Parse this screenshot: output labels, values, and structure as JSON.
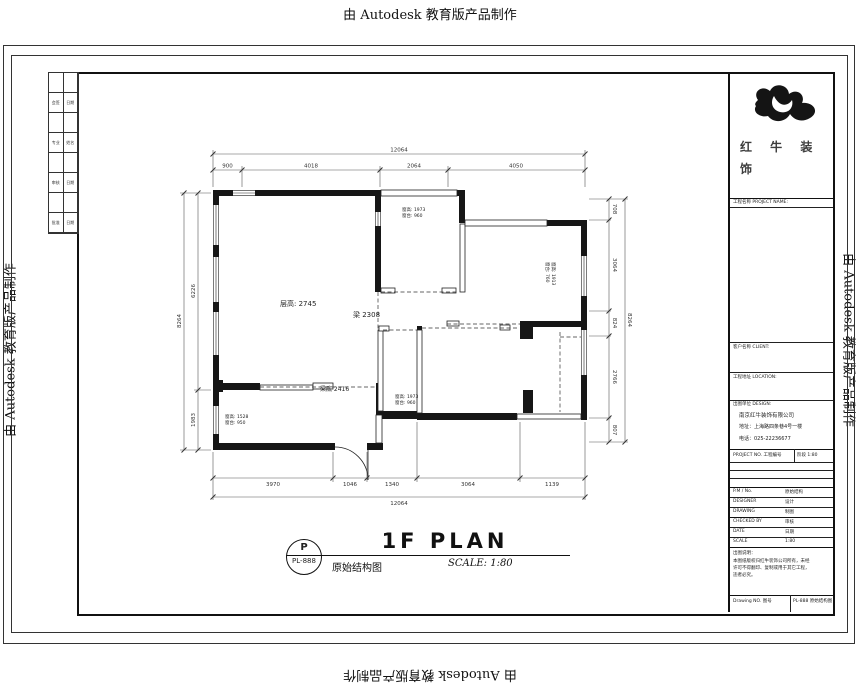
{
  "banners": {
    "top": "由 Autodesk 教育版产品制作",
    "bottom": "由 Autodesk 教育版产品制作",
    "left": "由 Autodesk 教育版产品制作",
    "right": "由 Autodesk 教育版产品制作"
  },
  "fold": {
    "rows": [
      {
        "c1": "会签",
        "c2": "日期"
      },
      {
        "c1": "专业",
        "c2": "姓名"
      },
      {
        "c1": "审核",
        "c2": "日期"
      },
      {
        "c1": "批准",
        "c2": "日期"
      }
    ]
  },
  "title_block": {
    "brand_line1": "红 牛 装",
    "brand_line2": "饰",
    "project_label": "工程名称 PROJECT NAME:",
    "client_label": "客户名称 CLIENT:",
    "location_label": "工程地址 LOCATION:",
    "design_label": "出图单位 DESIGN:",
    "company_name": "南京红牛装饰有限公司",
    "company_address": "地址：上海路四条巷4号一楼",
    "company_phone": "电话：025-22236677",
    "row_project": {
      "label": "PROJECT NO. 工程编号",
      "value": "阶段 1:80"
    },
    "rows": [
      {
        "label": "P.M / No.",
        "value": "原始结构"
      },
      {
        "label": "DESIGNER",
        "value": "设计"
      },
      {
        "label": "DRAWING",
        "value": "制图"
      },
      {
        "label": "CHECKED BY",
        "value": "审核"
      },
      {
        "label": "DATE",
        "value": "日期"
      },
      {
        "label": "SCALE",
        "value": "1:80"
      }
    ],
    "notes_title": "出图说明：",
    "notes": [
      "本图纸版权归红牛装饰公司所有，未经",
      "许可不得翻印、复制或用于其它工程，",
      "违者必究。"
    ],
    "drawing_no_label": "Drawing NO. 图号",
    "drawing_no_value": "PL-888 原始结构图"
  },
  "drawing_title": {
    "circle_top": "P",
    "circle_bottom": "PL-888",
    "title": "1F PLAN",
    "subtitle": "原始结构图",
    "scale": "SCALE: 1:80"
  },
  "plan": {
    "annotations": {
      "ceiling": "层高: 2745",
      "beam_mid": "梁 2308",
      "beam_bottom": "梁底 2416",
      "win_top_l1": "窗高: 1973",
      "win_top_l2": "窗台: 960",
      "win_right_l1": "窗高: 1913",
      "win_right_l2": "窗台: 760",
      "win_bath_l1": "窗高: 1973",
      "win_bath_l2": "窗台: 960",
      "win_kitchen_l1": "窗高: 1528",
      "win_kitchen_l2": "窗台: 950"
    },
    "dims": {
      "top_total": "12064",
      "top_segments": [
        "900",
        "4018",
        "2064",
        "4050"
      ],
      "bottom_total": "12064",
      "bottom_segments": [
        "3970",
        "1046",
        "1340",
        "3064",
        "1139"
      ],
      "left_total": "8264",
      "left_segments": [
        "6226",
        "1983"
      ],
      "right_total": "8264",
      "right_segments": [
        "708",
        "3064",
        "824",
        "2766",
        "807"
      ]
    },
    "colors": {
      "wall": "#161616",
      "line": "#222222",
      "dim": "#555555"
    }
  }
}
